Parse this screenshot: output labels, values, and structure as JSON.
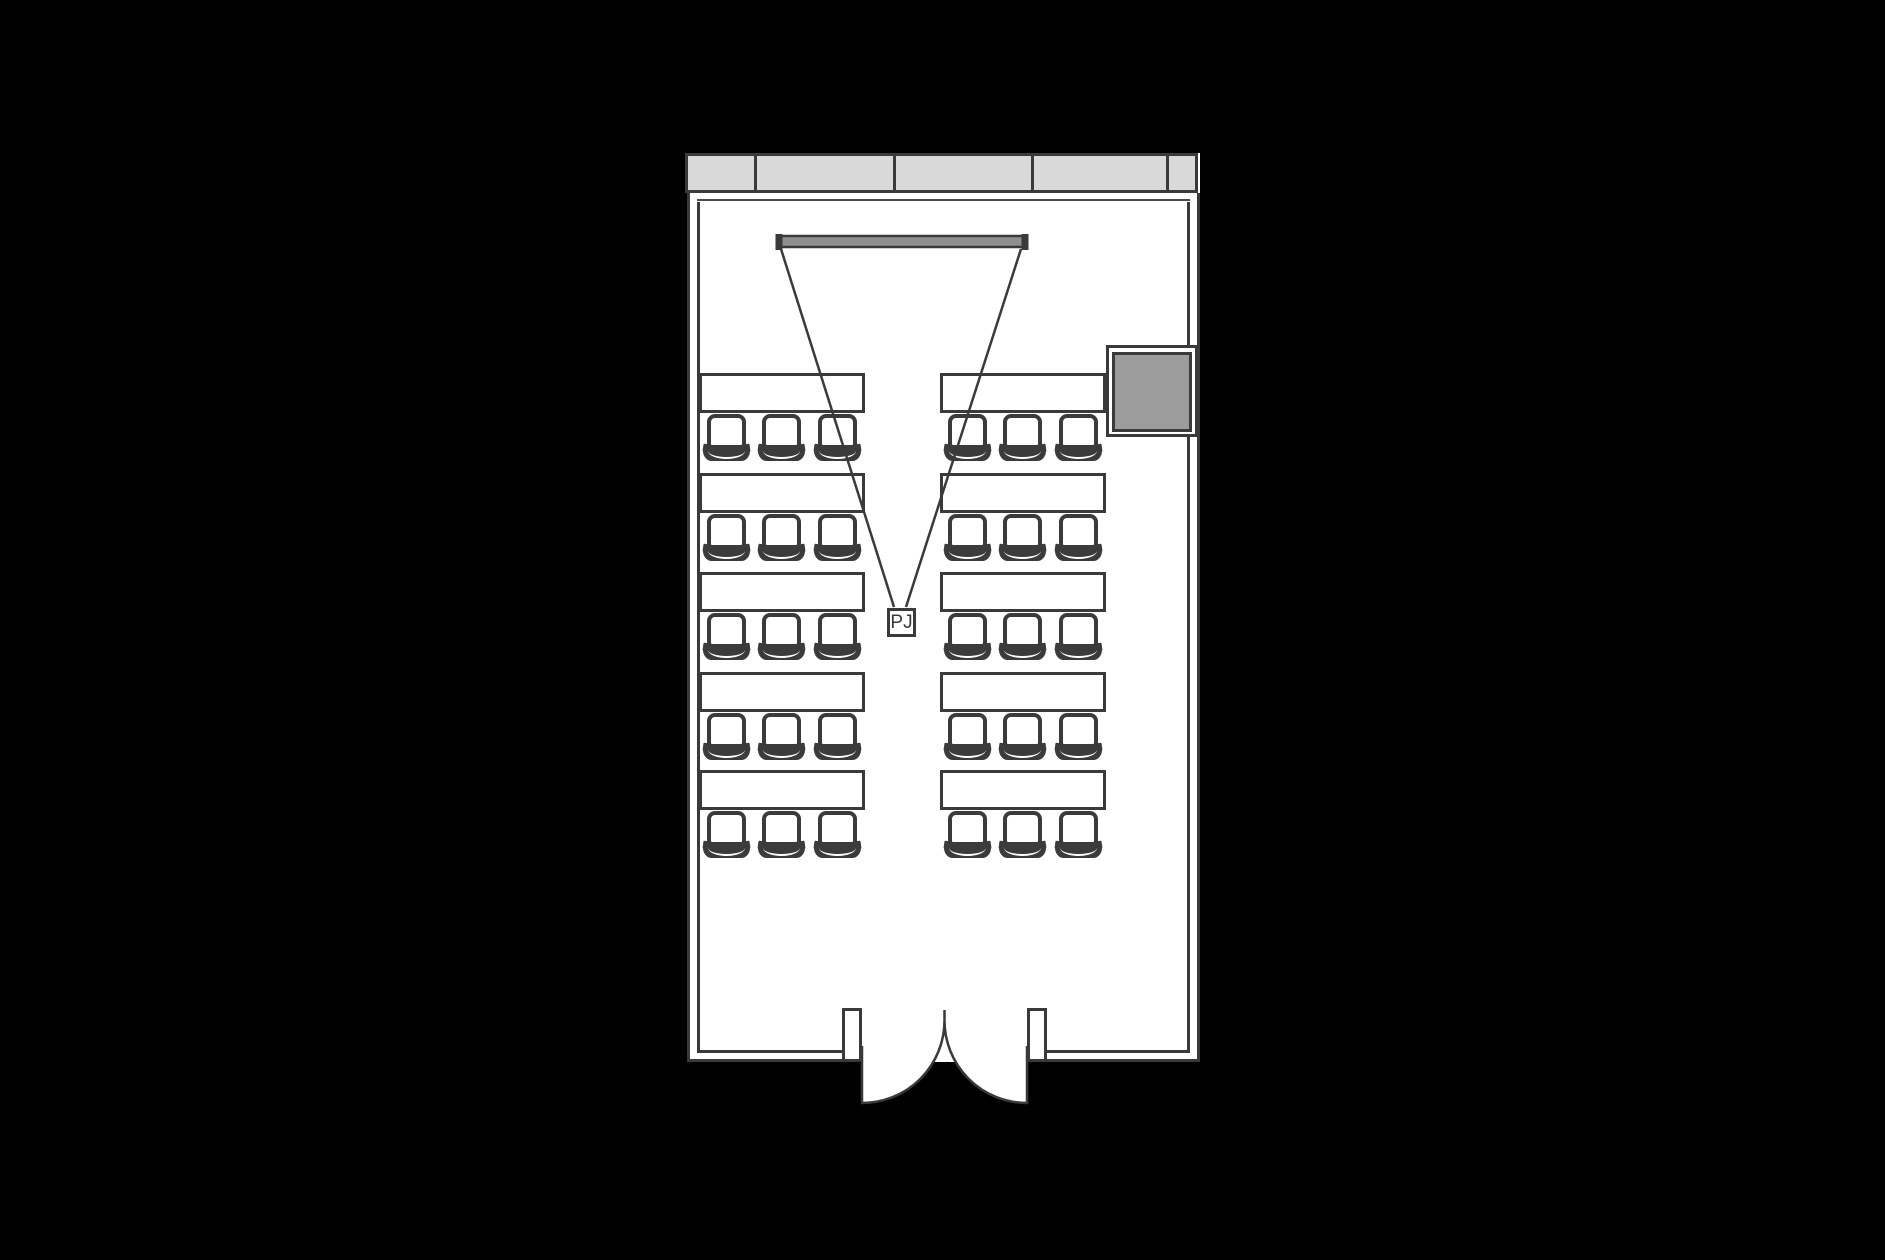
{
  "title": "Seminar room floor plan",
  "floorplan": {
    "projector": {
      "label": "PJ"
    },
    "colors": {
      "background": "#000000",
      "room_fill": "#ffffff",
      "outline": "#3a3a3a",
      "window_fill": "#d9d9d9",
      "screen_fill": "#8f8f8f",
      "cabinet_fill": "#9c9c9c"
    },
    "windows": {
      "segments": 5
    },
    "seating": {
      "desk_rows": 5,
      "desk_columns": 2,
      "chairs_per_desk": 3,
      "total_desks": 10,
      "total_chairs": 30
    },
    "door": {
      "type": "double-swing",
      "leaves": 2
    }
  }
}
